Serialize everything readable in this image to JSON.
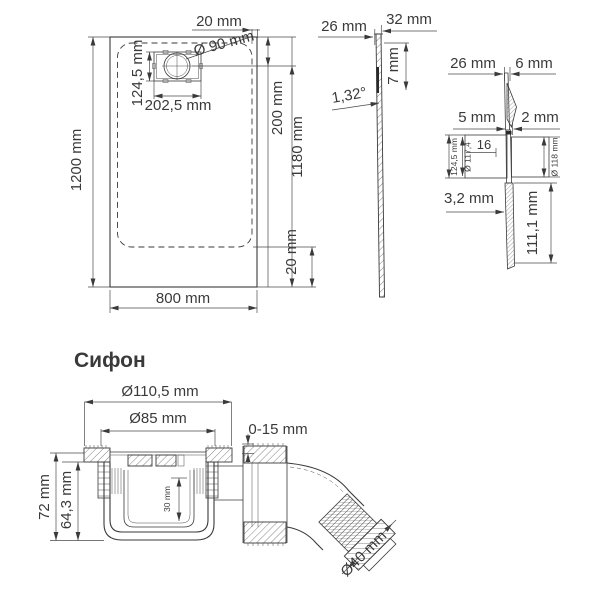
{
  "colors": {
    "line": "#3a3a3a",
    "title": "#2e3a5c",
    "background": "#ffffff"
  },
  "plan": {
    "dim_top": "20 mm",
    "dim_drain_diameter": "Ø 90 mm",
    "dim_drain_height": "124,5 mm",
    "dim_drain_width": "202,5 mm",
    "dim_right_upper": "200 mm",
    "dim_right_inner": "1180 mm",
    "dim_right_lower": "20 mm",
    "dim_left": "1200 mm",
    "dim_bottom": "800 mm"
  },
  "section": {
    "dim_left_top": "26 mm",
    "dim_right_top": "32 mm",
    "dim_depth": "7 mm",
    "dim_angle": "1,32°"
  },
  "detail": {
    "dim_top_left": "26 mm",
    "dim_top_right": "6 mm",
    "dim_mid_left": "5 mm",
    "dim_mid_right": "2 mm",
    "dim_inner": "16",
    "dim_box_height": "124,5 mm",
    "dim_inner_diameter": "Ø 117,4",
    "dim_outer_diameter": "Ø 118 mm",
    "dim_thickness": "3,2 mm",
    "dim_lower_height": "111,1 mm"
  },
  "siphon": {
    "title": "Сифон",
    "dim_outer_diameter": "Ø110,5 mm",
    "dim_inner_diameter": "Ø85 mm",
    "dim_adjust_range": "0-15 mm",
    "dim_total_height": "72 mm",
    "dim_body_height": "64,3 mm",
    "dim_water_seal": "30 mm",
    "dim_outlet_diameter": "Ø40 mm"
  }
}
